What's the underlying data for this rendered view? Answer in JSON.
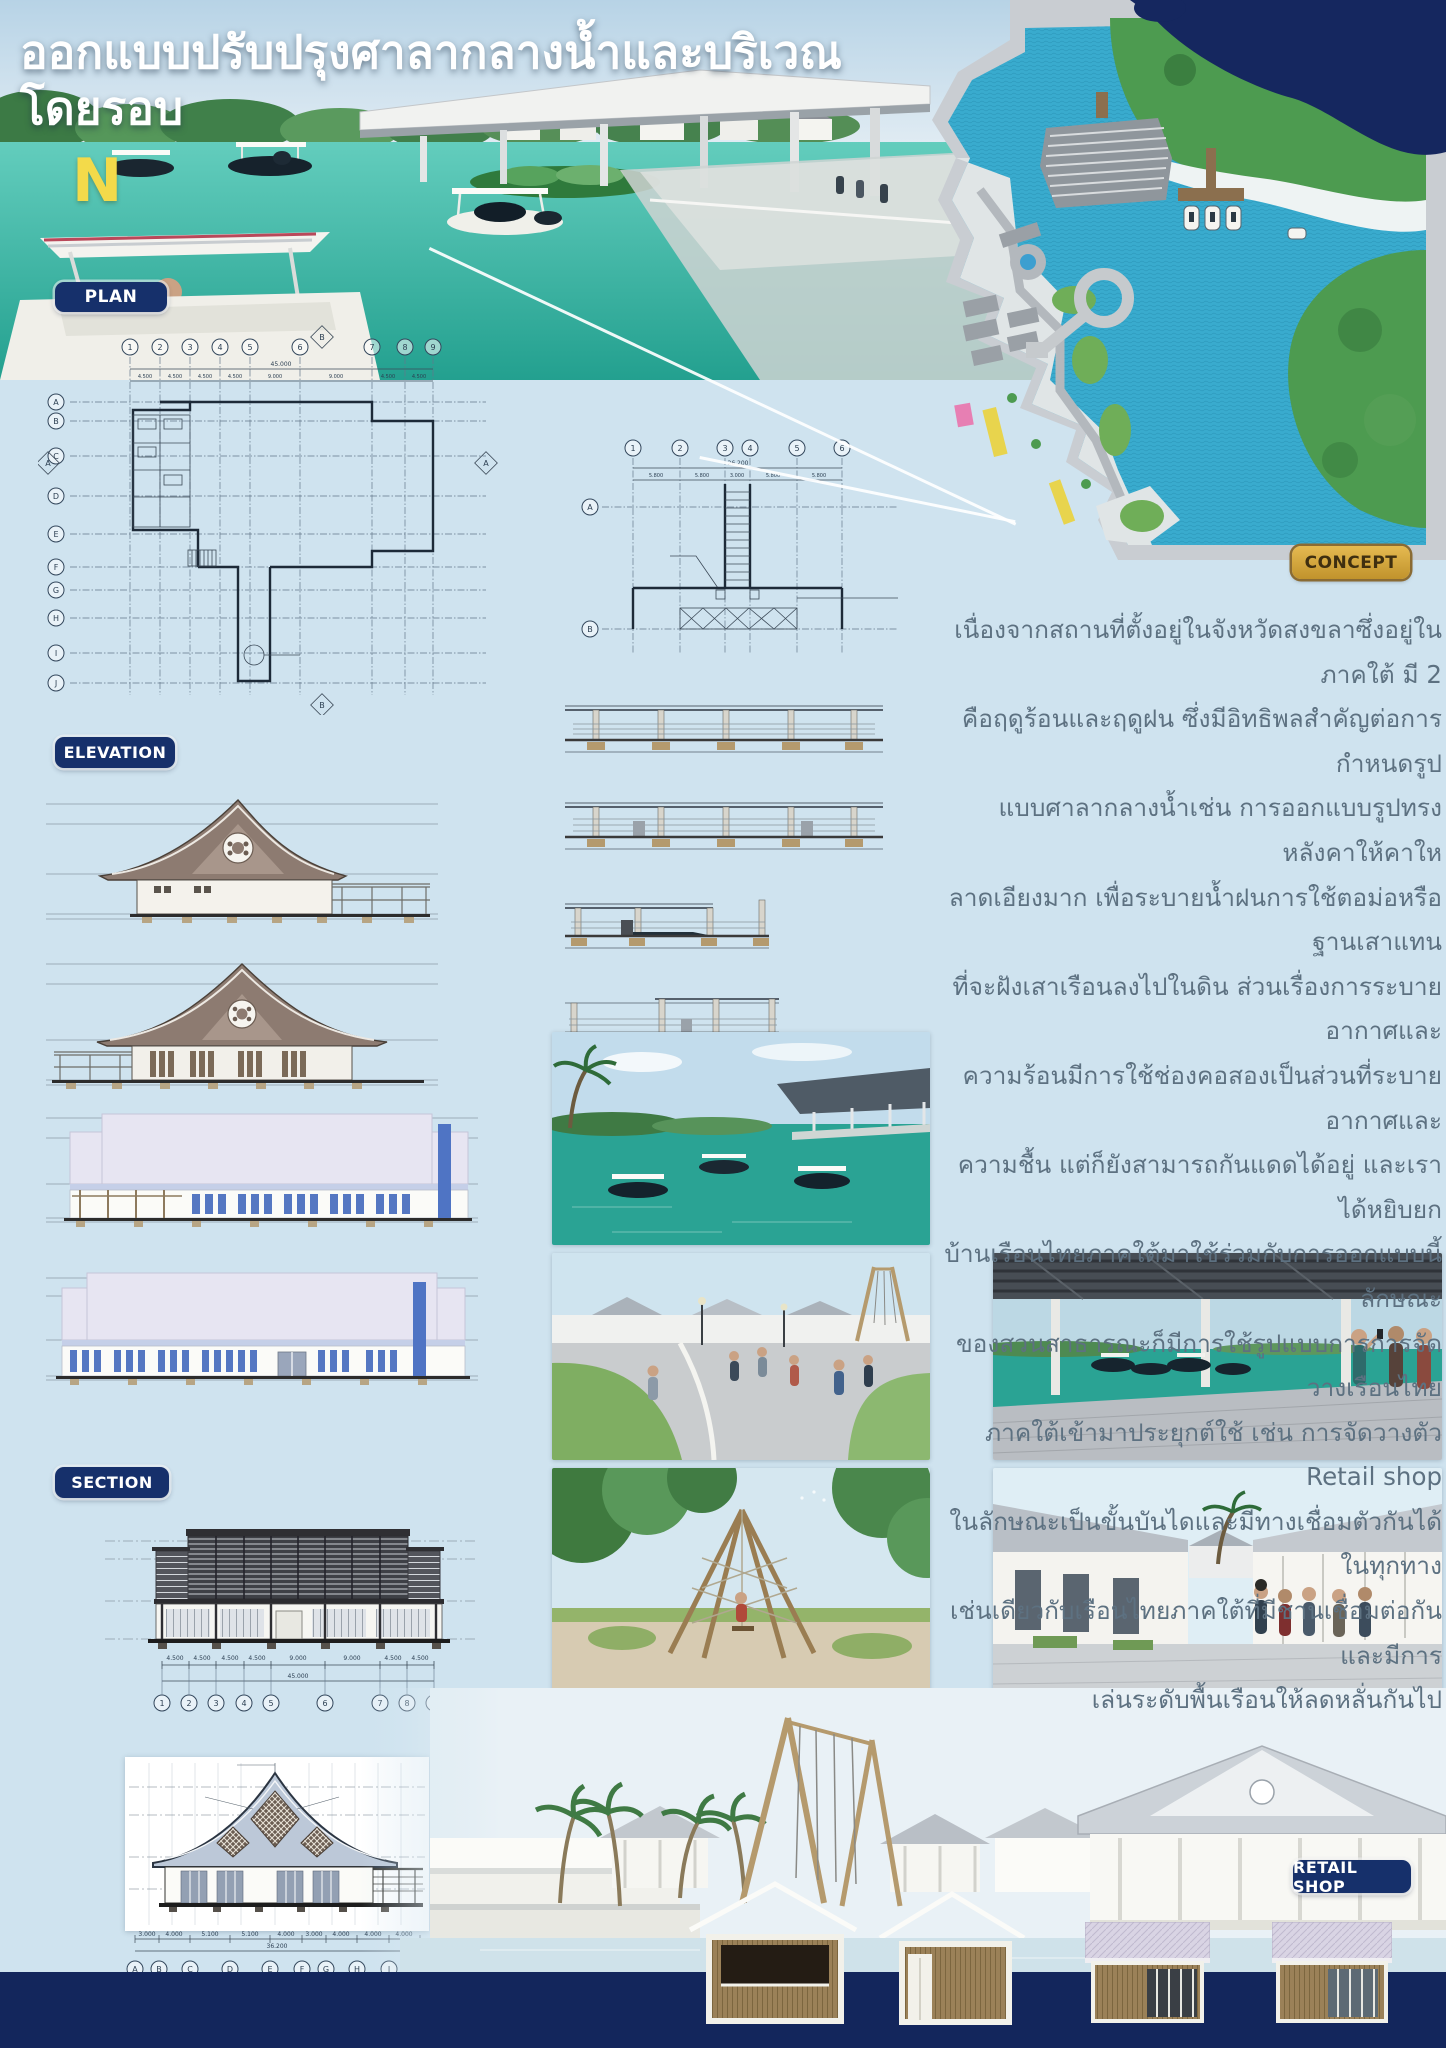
{
  "poster": {
    "title": "ออกแบบปรับปรุงศาลากลางน้ำและบริเวณโดยรอบ",
    "compass_n": "N"
  },
  "badges": {
    "plan": "PLAN",
    "concept": "CONCEPT",
    "elevation": "ELEVATION",
    "section": "SECTION",
    "retail_shop": "RETAIL SHOP"
  },
  "concept": {
    "lines": [
      "เนื่องจากสถานที่ตั้งอยู่ในจังหวัดสงขลาซึ่งอยู่ในภาคใต้ มี 2",
      "คือฤดูร้อนและฤดูฝน ซึ่งมีอิทธิพลสำคัญต่อการกำหนดรูป",
      "แบบศาลากลางน้ำเช่น การออกแบบรูปทรงหลังคาให้คาให",
      "ลาดเอียงมาก เพื่อระบายน้ำฝนการใช้ตอม่อหรือฐานเสาแทน",
      "ที่จะฝังเสาเรือนลงไปในดิน ส่วนเรื่องการระบายอากาศและ",
      "ความร้อนมีการใช้ช่องคอสองเป็นส่วนที่ระบายอากาศและ",
      "ความชื้น แต่ก็ยังสามารถกันแดดได้อยู่ และเราได้หยิบยก",
      "บ้านเรือนไทยภาคใต้มาใช้ร่วมกับการออกแบบนี้ ลักษณะ",
      "ของสวนสาธารณะก็มีการใช้รูปแบบการการจัดวางเรือนไทย",
      "ภาคใต้เข้ามาประยุกต์ใช้ เช่น การจัดวางตัว Retail shop",
      "ในลักษณะเป็นขั้นบันไดและมีทางเชื่อมตัวกันได้ในทุกทาง",
      "เช่นเดียวกับเรือนไทยภาคใต้ที่มีชานเชื่อมต่อกันและมีการ",
      "เล่นระดับพื้นเรือนให้ลดหลั่นกันไป"
    ]
  },
  "plan1": {
    "cols": [
      "1",
      "2",
      "3",
      "4",
      "5",
      "6",
      "7",
      "8",
      "9"
    ],
    "rows": [
      "A",
      "B",
      "C",
      "D",
      "E",
      "F",
      "G",
      "H",
      "I",
      "J"
    ],
    "total_dim": "45.000",
    "span_dims": [
      "4.500",
      "4.500",
      "4.500",
      "4.500",
      "9.000",
      "9.000",
      "4.500",
      "4.500"
    ],
    "section_marker_a": "A",
    "section_marker_b": "B"
  },
  "plan2": {
    "cols": [
      "1",
      "2",
      "3",
      "4",
      "5",
      "6"
    ],
    "rows": [
      "A",
      "B"
    ],
    "total_dim": "26.200",
    "span_dims": [
      "5.800",
      "5.800",
      "3.000",
      "5.800",
      "5.800"
    ]
  },
  "section1": {
    "cols": [
      "1",
      "2",
      "3",
      "4",
      "5",
      "6",
      "7",
      "8",
      "9"
    ],
    "total_dim": "45.000",
    "span_dims": [
      "4.500",
      "4.500",
      "4.500",
      "4.500",
      "9.000",
      "9.000",
      "4.500",
      "4.500"
    ]
  },
  "section2": {
    "cols": [
      "A",
      "B",
      "C",
      "D",
      "E",
      "F",
      "G",
      "H",
      "I",
      "J"
    ],
    "total_dim": "36.200",
    "span_dims": [
      "3.000",
      "4.000",
      "5.100",
      "5.100",
      "4.000",
      "3.000",
      "4.000",
      "4.000",
      "4.000"
    ]
  },
  "colors": {
    "poster_bg": "#cfe3ef",
    "navy": "#16306b",
    "badge_gold": "#d2a43e",
    "hero_water": "#2fa897",
    "map_water": "#39abce",
    "concept_text": "#5d7181",
    "accent_blue": "#4f74c4"
  }
}
